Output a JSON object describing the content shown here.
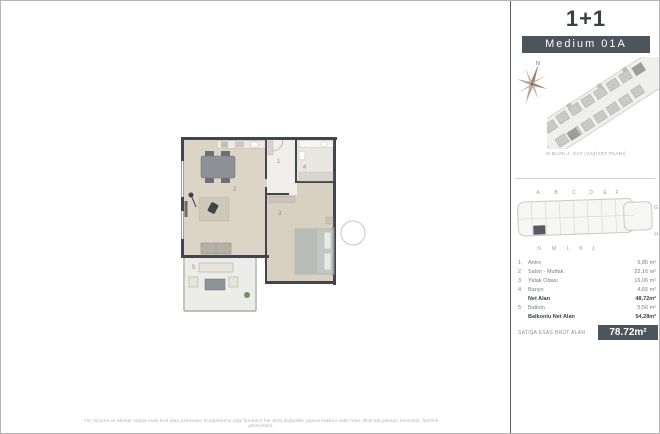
{
  "header": {
    "type_label": "1+1",
    "variant_label": "Medium 01A"
  },
  "compass": {
    "north_label": "N"
  },
  "site_plan": {
    "caption": "M BLOK 4. KAT (VAZİYET PLANI)"
  },
  "floor_diagram": {
    "top_letters": [
      "A",
      "B",
      "C",
      "D",
      "E",
      "F"
    ],
    "right_letters": [
      "G",
      "H"
    ],
    "bottom_letters": [
      "N",
      "M",
      "L",
      "K",
      "J"
    ]
  },
  "plan": {
    "labels": [
      "1",
      "2",
      "3",
      "4",
      "5"
    ]
  },
  "area_table": {
    "rows": [
      {
        "no": "1",
        "name": "Antre",
        "value": "5,85 m²"
      },
      {
        "no": "2",
        "name": "Salon - Mutfak",
        "value": "22,16 m²"
      },
      {
        "no": "3",
        "name": "Yatak Odası",
        "value": "16,06 m²"
      },
      {
        "no": "4",
        "name": "Banyo",
        "value": "4,65 m²"
      },
      {
        "no": "",
        "name": "Net Alan",
        "value": "48,72m²"
      },
      {
        "no": "5",
        "name": "Balkon",
        "value": "5,56 m²"
      },
      {
        "no": "",
        "name": "Balkonlu Net Alan",
        "value": "54,28m²"
      }
    ],
    "gross_label": "SATIŞA ESAS BRÜT ALAN",
    "gross_value": "78.72m²"
  },
  "footer": {
    "disclaimer": "Yüz ölçümü ve alanlar satışa esas brüt alan üzerinden hesaplanmış olup firmamız her türlü değişiklik yapma hakkını saklı tutar. Blok kat planları temsilidir, farklılık gösterebilir."
  },
  "colors": {
    "badge_dark": "#4c545c",
    "wall": "#41464c",
    "floor_beige": "#dcd5c7"
  }
}
